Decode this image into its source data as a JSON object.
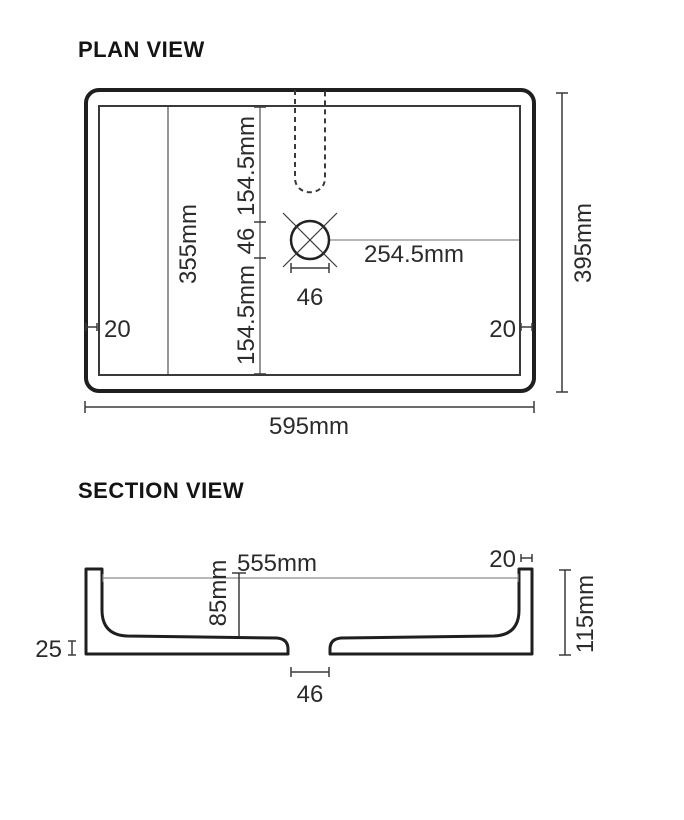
{
  "plan_view": {
    "title": "PLAN VIEW",
    "inner_length": "355mm",
    "drain_offset_top": "154.5mm",
    "drain_gap": "46",
    "drain_offset_bottom": "154.5mm",
    "drain_to_wall": "254.5mm",
    "drain_width": "46",
    "wall_left": "20",
    "wall_right": "20",
    "overall_depth": "395mm",
    "overall_width": "595mm"
  },
  "section_view": {
    "title": "SECTION VIEW",
    "inner_width": "555mm",
    "wall_thickness": "20",
    "bowl_depth": "85mm",
    "overall_height": "115mm",
    "base_thickness": "25",
    "drain_width": "46"
  },
  "colors": {
    "line": "#1f1f1f",
    "dim_line": "#3a3a3a",
    "text": "#2b2b2b",
    "background": "#ffffff"
  }
}
